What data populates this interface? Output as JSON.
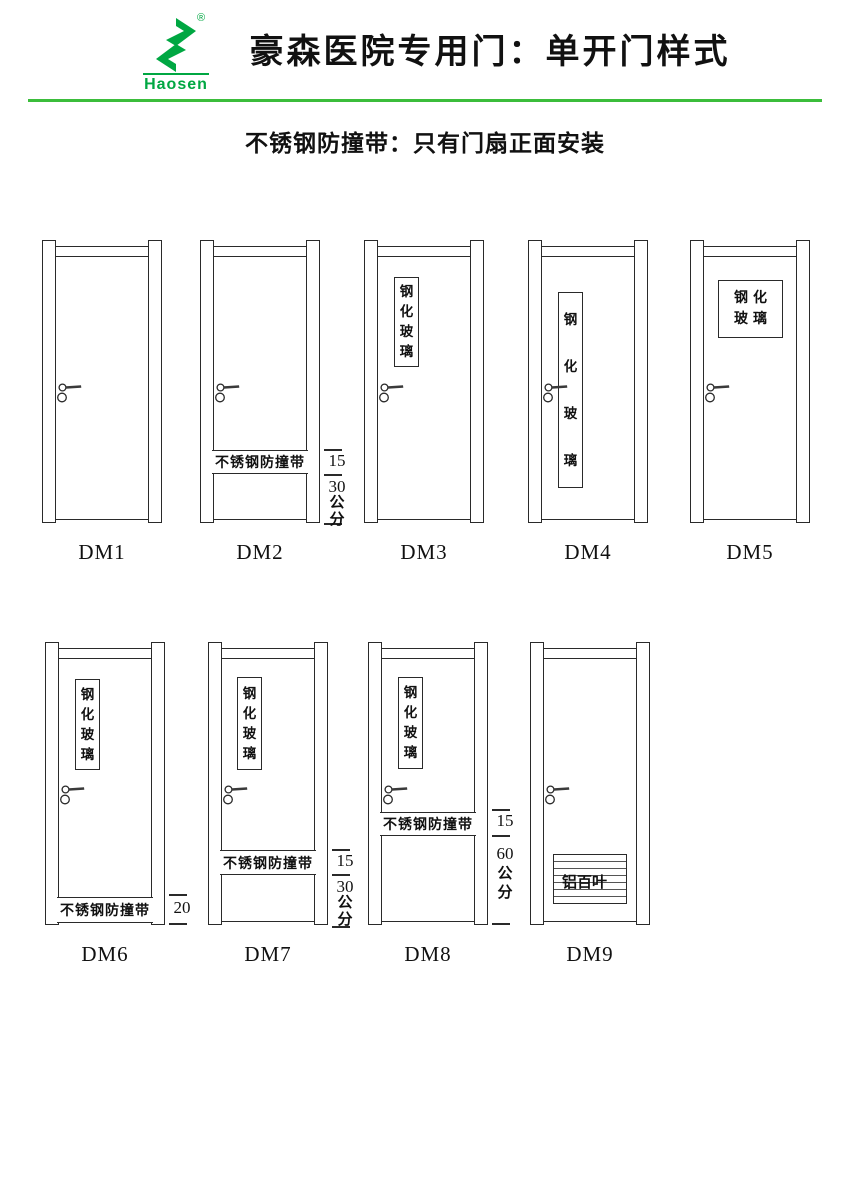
{
  "header": {
    "brand": "Haosen",
    "registered_mark": "®",
    "title": "豪森医院专用门：单开门样式",
    "subtitle": "不锈钢防撞带：只有门扇正面安装",
    "brand_green": "#00a742",
    "divider_green": "#3bbd3b"
  },
  "doors": [
    {
      "label": "DM1"
    },
    {
      "label": "DM2",
      "band_text": "不锈钢防撞带",
      "dims": {
        "upper": "15",
        "lower_num": "30",
        "lower_unit": "公分"
      }
    },
    {
      "label": "DM3",
      "glass_text": "钢化玻璃"
    },
    {
      "label": "DM4",
      "glass_text": "钢化玻璃"
    },
    {
      "label": "DM5",
      "glass_line1": "钢化",
      "glass_line2": "玻璃"
    },
    {
      "label": "DM6",
      "glass_text": "钢化玻璃",
      "band_text": "不锈钢防撞带",
      "dims": {
        "value": "20"
      }
    },
    {
      "label": "DM7",
      "glass_text": "钢化玻璃",
      "band_text": "不锈钢防撞带",
      "dims": {
        "upper": "15",
        "lower_num": "30",
        "lower_unit": "公分"
      }
    },
    {
      "label": "DM8",
      "glass_text": "钢化玻璃",
      "band_text": "不锈钢防撞带",
      "dims": {
        "upper": "15",
        "lower_num": "60",
        "lower_unit": "公分"
      }
    },
    {
      "label": "DM9",
      "louver_text": "铝百叶"
    }
  ]
}
